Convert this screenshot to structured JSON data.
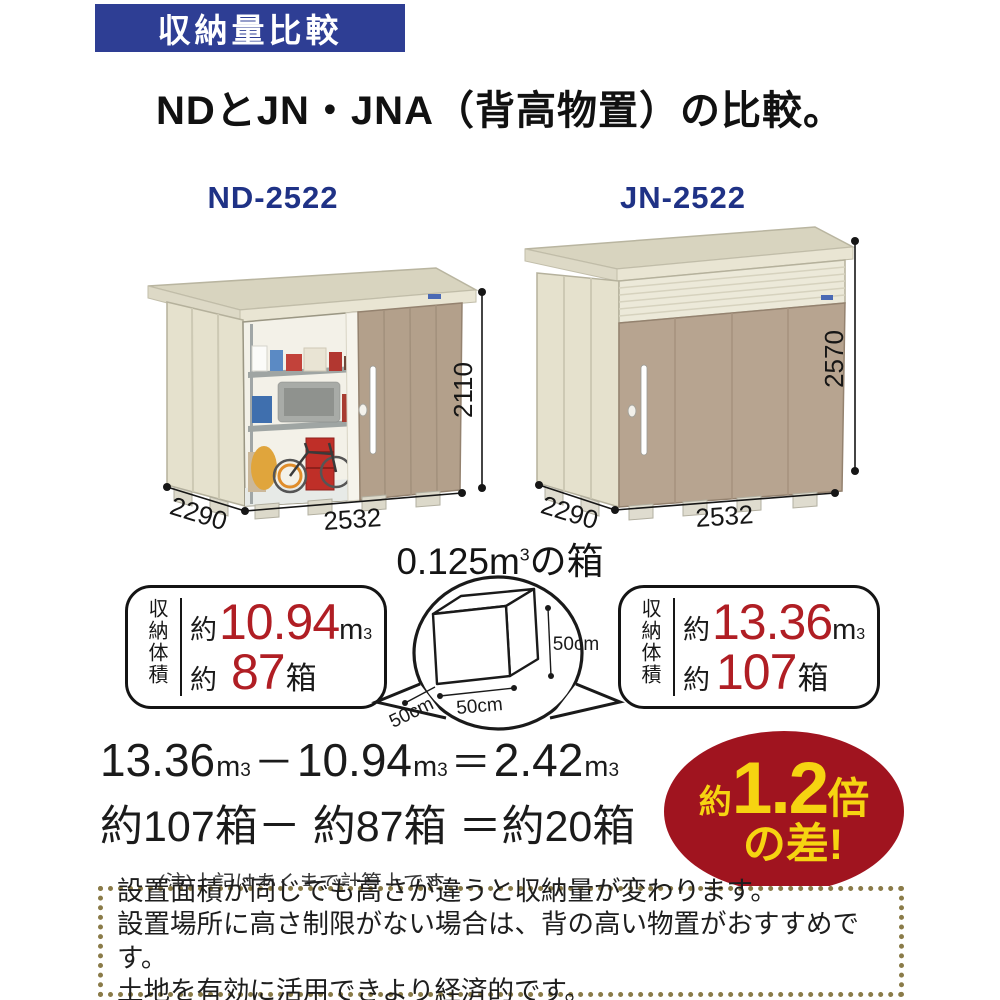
{
  "header": {
    "banner_label": "収納量比較",
    "title": "NDとJN・JNA（背高物置）の比較。"
  },
  "sheds": {
    "nd": {
      "model": "ND-2522",
      "height": "2110",
      "depth": "2290",
      "width": "2532"
    },
    "jn": {
      "model": "JN-2522",
      "height": "2570",
      "depth": "2290",
      "width": "2532"
    }
  },
  "box_diagram": {
    "title_value": "0.125",
    "title_unit": "m",
    "title_sup": "3",
    "title_suffix": "の箱",
    "dim_height": "50cm",
    "dim_width": "50cm",
    "dim_depth": "50cm"
  },
  "stats": {
    "label": "収納体積",
    "nd": {
      "approx": "約",
      "volume": "10.94",
      "unit": "m",
      "unit_sup": "3",
      "approx2": "約",
      "boxes": "87",
      "boxes_unit": "箱"
    },
    "jn": {
      "approx": "約",
      "volume": "13.36",
      "unit": "m",
      "unit_sup": "3",
      "approx2": "約",
      "boxes": "107",
      "boxes_unit": "箱"
    }
  },
  "calculation": {
    "line1": [
      "13.36",
      "m",
      "3",
      "－",
      "10.94",
      "m",
      "3",
      "＝",
      "2.42",
      "m",
      "3"
    ],
    "line2": "約107箱－ 約87箱 ＝約20箱",
    "note": "(注)上記はあくまで計算上です。"
  },
  "badge": {
    "prefix": "約",
    "value": "1.2",
    "suffix": "倍",
    "line2": "の差!"
  },
  "footer": {
    "lines": [
      "設置面積が同じでも高さが違うと収納量が変わります。",
      "設置場所に高さ制限がない場合は、背の高い物置がおすすめです。",
      "土地を有効に活用できより経済的です。"
    ]
  },
  "colors": {
    "banner_bg": "#2e3e94",
    "model_label": "#1f3286",
    "accent_red": "#b01e24",
    "badge_bg": "#a0141f",
    "badge_text": "#f6d411",
    "dotted_border": "#8a7b48",
    "shed_wall": "#e8e4d2",
    "shed_door_tan": "#b5a28d"
  }
}
